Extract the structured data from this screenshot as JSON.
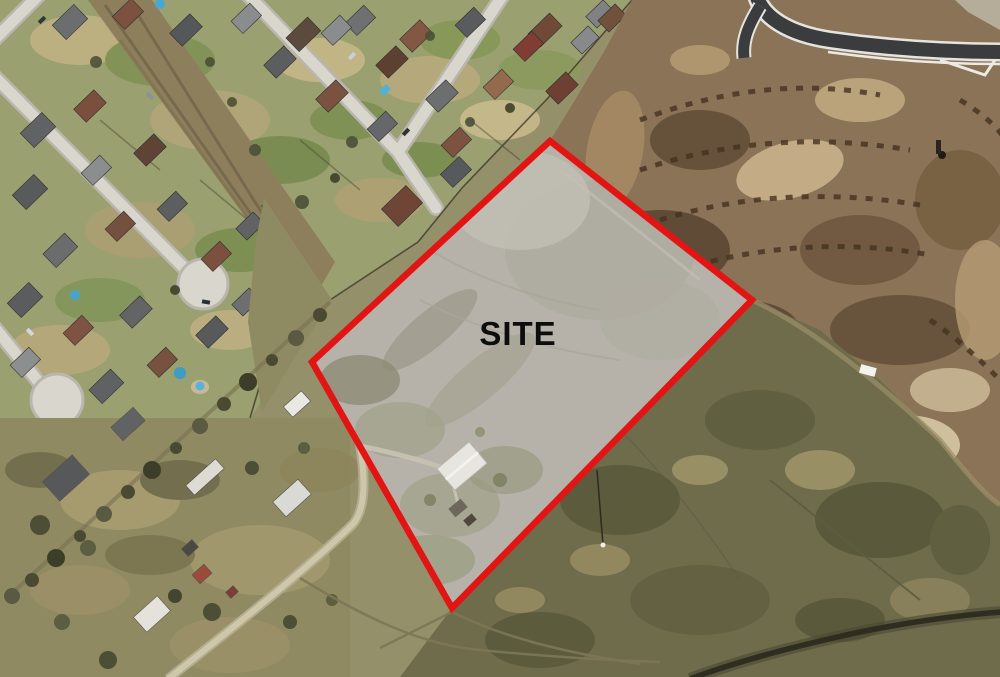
{
  "site_overlay": {
    "label": "SITE",
    "polygon_points": "550,141 752,300 452,608 312,362",
    "border_color": "#e21414",
    "fill_color": "#b6b2a9",
    "label_color": "#0d0d0d"
  },
  "palette": {
    "scrub_base": "#93906a",
    "suburb_grass": "#9aa06f",
    "construction_dirt": "#8a7356",
    "field_green": "#6f6c4c",
    "street_concrete": "#d9d6cd",
    "asphalt_road": "#3b3c3e",
    "creek_dark": "#2f2d20",
    "roof_gray": "#5d5f61",
    "roof_brown": "#7b513f",
    "pool_blue": "#45a6cc",
    "metal_roof_white": "#e7e5e0",
    "gravel_road": "#cfc7aa"
  }
}
